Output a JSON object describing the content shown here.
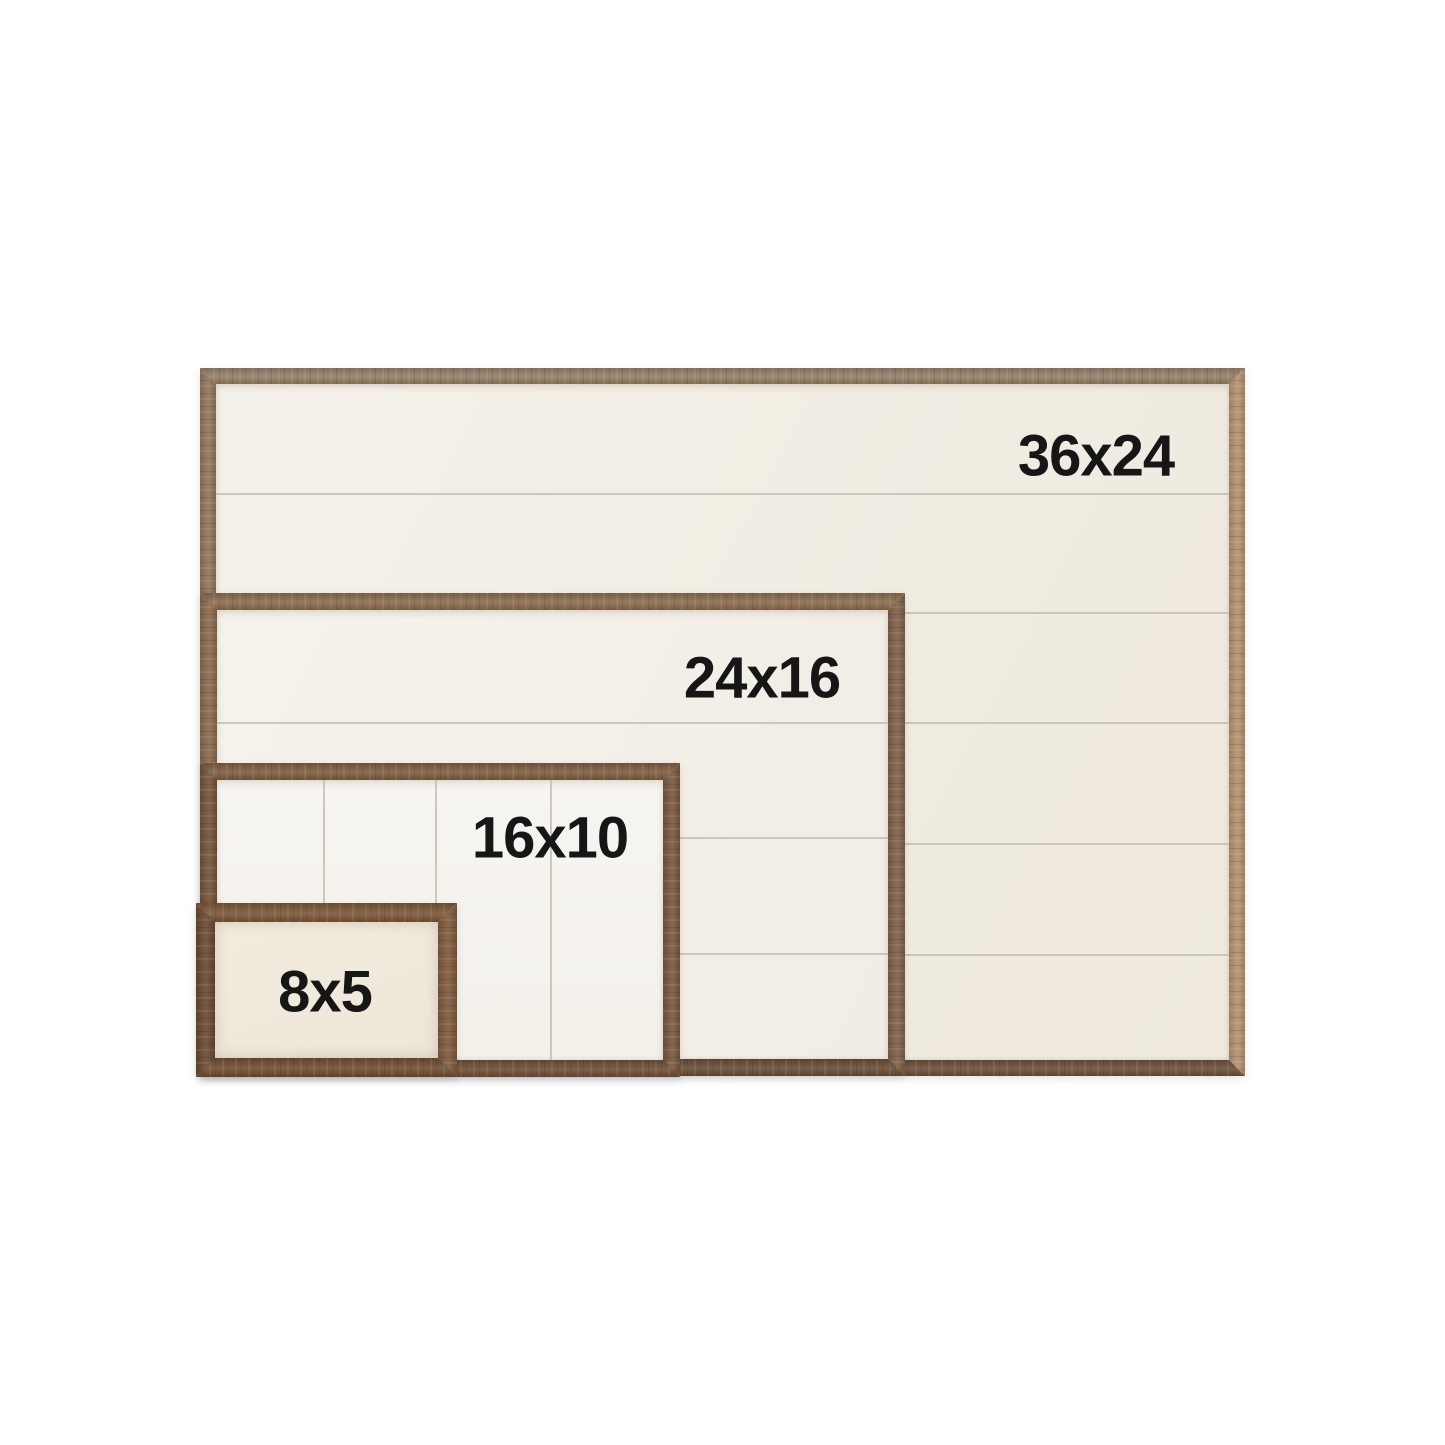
{
  "frames": [
    {
      "id": "f36",
      "label": "36x24",
      "width_in": 36,
      "height_in": 24,
      "planks": "horizontal",
      "plank_count": 6
    },
    {
      "id": "f24",
      "label": "24x16",
      "width_in": 24,
      "height_in": 16,
      "planks": "horizontal",
      "plank_count": 4
    },
    {
      "id": "f16",
      "label": "16x10",
      "width_in": 16,
      "height_in": 10,
      "planks": "vertical",
      "plank_count": 4
    },
    {
      "id": "f8",
      "label": "8x5",
      "width_in": 8,
      "height_in": 5,
      "planks": "none",
      "plank_count": 1
    }
  ],
  "colors": {
    "background": "#ffffff",
    "label-text": "#161616",
    "plank-line": "#c2bdb2",
    "wood-light": "#b2906e",
    "wood-medium": "#84644a",
    "wood-dark": "#6d5039",
    "panel-cream": "#f1ece2",
    "panel-bright": "#f6f4f0",
    "panel-warm": "#efe8db"
  }
}
